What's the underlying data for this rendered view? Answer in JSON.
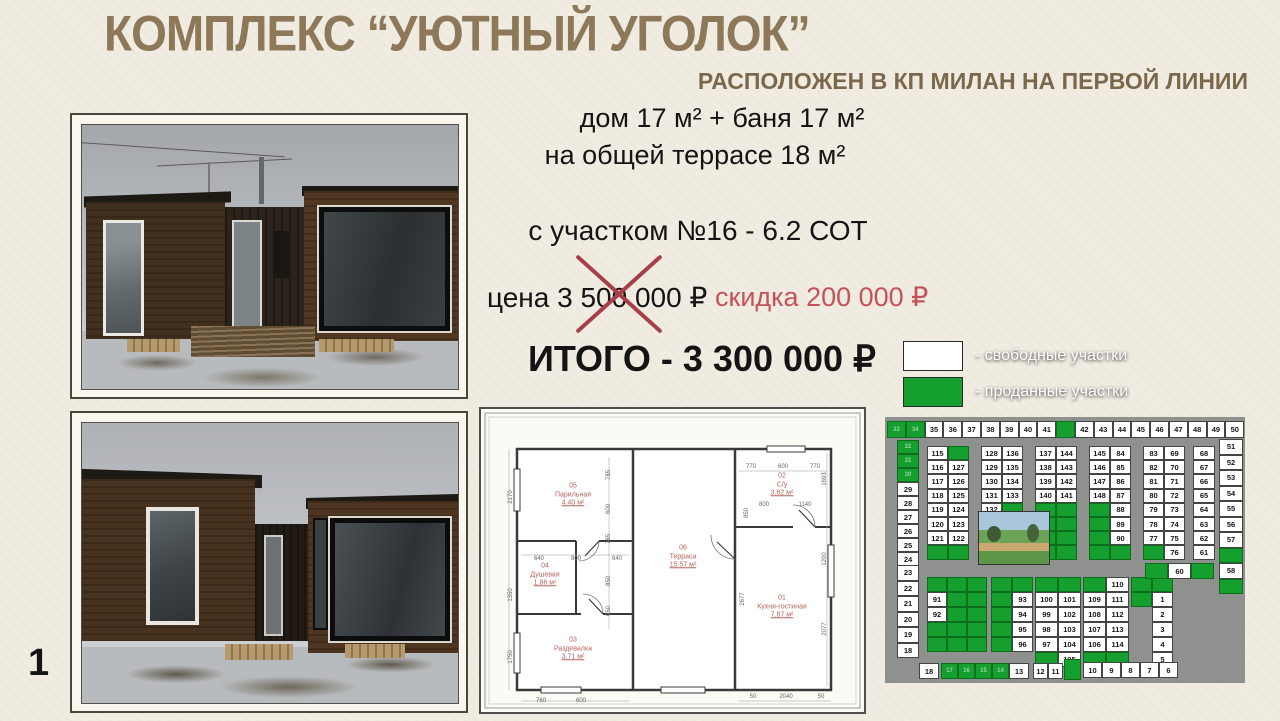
{
  "title": "КОМПЛЕКС “УЮТНЫЙ УГОЛОК”",
  "subtitle": "РАСПОЛОЖЕН В КП МИЛАН НА ПЕРВОЙ ЛИНИИ",
  "specs": {
    "line1": "дом 17 м² + баня 17 м²",
    "line2": "на общей террасе 18 м²",
    "plot": "с участком №16 - 6.2 СОТ"
  },
  "pricing": {
    "old_price_label": "цена 3 500 000 ₽",
    "discount_label": "скидка 200 000 ₽",
    "total_label": "ИТОГО - 3 300 000 ₽",
    "discount_color": "#c4525c",
    "cross_color": "#a63f49"
  },
  "page_number": "1",
  "floor_plan": {
    "rooms": [
      {
        "num": "05",
        "name": "Парильная",
        "area": "4.40 м²",
        "x": 92,
        "y": 86
      },
      {
        "num": "04",
        "name": "Душевая",
        "area": "1.86 м²",
        "x": 64,
        "y": 166
      },
      {
        "num": "03",
        "name": "Раздевалка",
        "area": "3.71 м²",
        "x": 92,
        "y": 240
      },
      {
        "num": "06",
        "name": "Терраса",
        "area": "15.57 м²",
        "x": 202,
        "y": 148
      },
      {
        "num": "02",
        "name": "С/у",
        "area": "3.62 м²",
        "x": 301,
        "y": 76
      },
      {
        "num": "01",
        "name": "Кухня-гостиная",
        "area": "7.87 м²",
        "x": 301,
        "y": 198
      }
    ],
    "dims": [
      {
        "t": "2170",
        "x": 30,
        "y": 88,
        "r": -90
      },
      {
        "t": "1350",
        "x": 30,
        "y": 186,
        "r": -90
      },
      {
        "t": "1750",
        "x": 30,
        "y": 248,
        "r": -90
      },
      {
        "t": "785",
        "x": 128,
        "y": 66,
        "r": -90
      },
      {
        "t": "600",
        "x": 128,
        "y": 100,
        "r": -90
      },
      {
        "t": "785",
        "x": 128,
        "y": 130,
        "r": -90
      },
      {
        "t": "850",
        "x": 128,
        "y": 172,
        "r": -90
      },
      {
        "t": "650",
        "x": 128,
        "y": 202,
        "r": -90
      },
      {
        "t": "640",
        "x": 58,
        "y": 150,
        "r": 0
      },
      {
        "t": "800",
        "x": 95,
        "y": 150,
        "r": 0
      },
      {
        "t": "640",
        "x": 136,
        "y": 150,
        "r": 0
      },
      {
        "t": "760",
        "x": 60,
        "y": 292,
        "r": 0
      },
      {
        "t": "600",
        "x": 100,
        "y": 292,
        "r": 0
      },
      {
        "t": "770",
        "x": 270,
        "y": 58,
        "r": 0
      },
      {
        "t": "600",
        "x": 302,
        "y": 58,
        "r": 0
      },
      {
        "t": "770",
        "x": 334,
        "y": 58,
        "r": 0
      },
      {
        "t": "800",
        "x": 283,
        "y": 96,
        "r": 0
      },
      {
        "t": "1140",
        "x": 324,
        "y": 96,
        "r": 0
      },
      {
        "t": "1693",
        "x": 344,
        "y": 70,
        "r": -90
      },
      {
        "t": "1200",
        "x": 344,
        "y": 150,
        "r": -90
      },
      {
        "t": "2077",
        "x": 344,
        "y": 220,
        "r": -90
      },
      {
        "t": "850",
        "x": 266,
        "y": 104,
        "r": -90
      },
      {
        "t": "2677",
        "x": 262,
        "y": 190,
        "r": -90
      },
      {
        "t": "50",
        "x": 272,
        "y": 288,
        "r": 0
      },
      {
        "t": "2040",
        "x": 305,
        "y": 288,
        "r": 0
      },
      {
        "t": "50",
        "x": 340,
        "y": 288,
        "r": 0
      }
    ]
  },
  "map": {
    "legend": [
      {
        "label": "- свободные участки",
        "color": "#ffffff"
      },
      {
        "label": "- проданные участки",
        "color": "#149f2e"
      }
    ],
    "colors": {
      "free": "#ffffff",
      "sold": "#149f2e",
      "road": "#8f918e"
    },
    "blocks": [
      {
        "x": 4,
        "y": 88,
        "cols": 19,
        "cw": 18.8,
        "ch": 17,
        "cells": [
          "#33",
          "#34",
          "35",
          "36",
          "37",
          "38",
          "39",
          "40",
          "41",
          "#",
          "42",
          "43",
          "44",
          "45",
          "46",
          "47",
          "48",
          "49",
          "50"
        ]
      },
      {
        "x": 14,
        "y": 107,
        "cols": 1,
        "cw": 22,
        "ch": 14,
        "cells": [
          "#32",
          "#31",
          "#30",
          "29",
          "28",
          "27",
          "26",
          "25",
          "24"
        ]
      },
      {
        "x": 14,
        "y": 232,
        "cols": 1,
        "cw": 22,
        "ch": 15.5,
        "cells": [
          "23",
          "22",
          "21",
          "20",
          "19",
          "18"
        ]
      },
      {
        "x": 336,
        "y": 106,
        "cols": 1,
        "cw": 24,
        "ch": 15.5,
        "cells": [
          "51",
          "52",
          "53",
          "54",
          "55",
          "56",
          "57",
          "#",
          "58",
          "#"
        ]
      },
      {
        "x": 44,
        "y": 113,
        "cols": 2,
        "cw": 21,
        "ch": 14.2,
        "cells": [
          "115",
          "#",
          "116",
          "127",
          "117",
          "126",
          "118",
          "125",
          "119",
          "124",
          "120",
          "123",
          "121",
          "122",
          "#",
          "#"
        ]
      },
      {
        "x": 98,
        "y": 113,
        "cols": 2,
        "cw": 21,
        "ch": 14.2,
        "cells": [
          "128",
          "136",
          "129",
          "135",
          "130",
          "134",
          "131",
          "133",
          "132",
          "#",
          "#",
          "#",
          "#",
          "#",
          "#",
          "#"
        ]
      },
      {
        "x": 152,
        "y": 113,
        "cols": 2,
        "cw": 21,
        "ch": 14.2,
        "cells": [
          "137",
          "144",
          "138",
          "143",
          "139",
          "142",
          "140",
          "141",
          "#",
          "#",
          "#",
          "#",
          "#",
          "#",
          "#",
          "#"
        ]
      },
      {
        "x": 206,
        "y": 113,
        "cols": 2,
        "cw": 21,
        "ch": 14.2,
        "cells": [
          "145",
          "84",
          "146",
          "85",
          "147",
          "86",
          "148",
          "87",
          "#",
          "88",
          "#",
          "89",
          "#",
          "90",
          "#",
          "#"
        ]
      },
      {
        "x": 260,
        "y": 113,
        "cols": 2,
        "cw": 21,
        "ch": 14.2,
        "cells": [
          "83",
          "69",
          "82",
          "70",
          "81",
          "71",
          "80",
          "72",
          "79",
          "73",
          "78",
          "74",
          "77",
          "75",
          "#",
          "76"
        ]
      },
      {
        "x": 310,
        "y": 113,
        "cols": 1,
        "cw": 22,
        "ch": 14.2,
        "cells": [
          "68",
          "67",
          "66",
          "65",
          "64",
          "63",
          "62",
          "61"
        ]
      },
      {
        "x": 44,
        "y": 244,
        "cols": 3,
        "cw": 20,
        "ch": 15,
        "cells": [
          "#",
          "#",
          "#",
          "91",
          "#",
          "#",
          "92",
          "#",
          "#",
          "#",
          "#",
          "#",
          "#",
          "#",
          "#"
        ]
      },
      {
        "x": 108,
        "y": 244,
        "cols": 2,
        "cw": 21,
        "ch": 15,
        "cells": [
          "#",
          "#",
          "#",
          "93",
          "#",
          "94",
          "#",
          "95",
          "#",
          "96"
        ]
      },
      {
        "x": 152,
        "y": 244,
        "cols": 2,
        "cw": 23,
        "ch": 15,
        "cells": [
          "#",
          "#",
          "100",
          "101",
          "99",
          "102",
          "98",
          "103",
          "97",
          "104",
          "#",
          "105"
        ]
      },
      {
        "x": 200,
        "y": 244,
        "cols": 2,
        "cw": 23,
        "ch": 15,
        "cells": [
          "#",
          "110",
          "109",
          "111",
          "108",
          "112",
          "107",
          "113",
          "106",
          "114",
          "#",
          "#"
        ]
      },
      {
        "x": 248,
        "y": 244,
        "cols": 2,
        "cw": 21,
        "ch": 15,
        "cells": [
          "#",
          "#",
          "#",
          "1",
          ".",
          "2",
          ".",
          "3",
          ".",
          "4",
          ".",
          "5"
        ]
      },
      {
        "x": 262,
        "y": 230,
        "cols": 3,
        "cw": 23,
        "ch": 16,
        "cells": [
          "#",
          "60",
          "#"
        ]
      },
      {
        "x": 36,
        "y": 330,
        "cols": 1,
        "cw": 20,
        "ch": 16,
        "cells": [
          "18"
        ]
      },
      {
        "x": 58,
        "y": 330,
        "cols": 4,
        "cw": 17,
        "ch": 16,
        "cells": [
          "#17",
          "#16",
          "#15",
          "#14"
        ]
      },
      {
        "x": 126,
        "y": 330,
        "cols": 1,
        "cw": 20,
        "ch": 16,
        "cells": [
          "13"
        ]
      },
      {
        "x": 150,
        "y": 330,
        "cols": 2,
        "cw": 15,
        "ch": 16,
        "cells": [
          "12",
          "11"
        ]
      },
      {
        "x": 181,
        "y": 326,
        "cols": 1,
        "cw": 17,
        "ch": 21,
        "cells": [
          "#"
        ]
      },
      {
        "x": 200,
        "y": 329,
        "cols": 5,
        "cw": 19,
        "ch": 16,
        "cells": [
          "10",
          "9",
          "8",
          "7",
          "6"
        ]
      }
    ]
  }
}
